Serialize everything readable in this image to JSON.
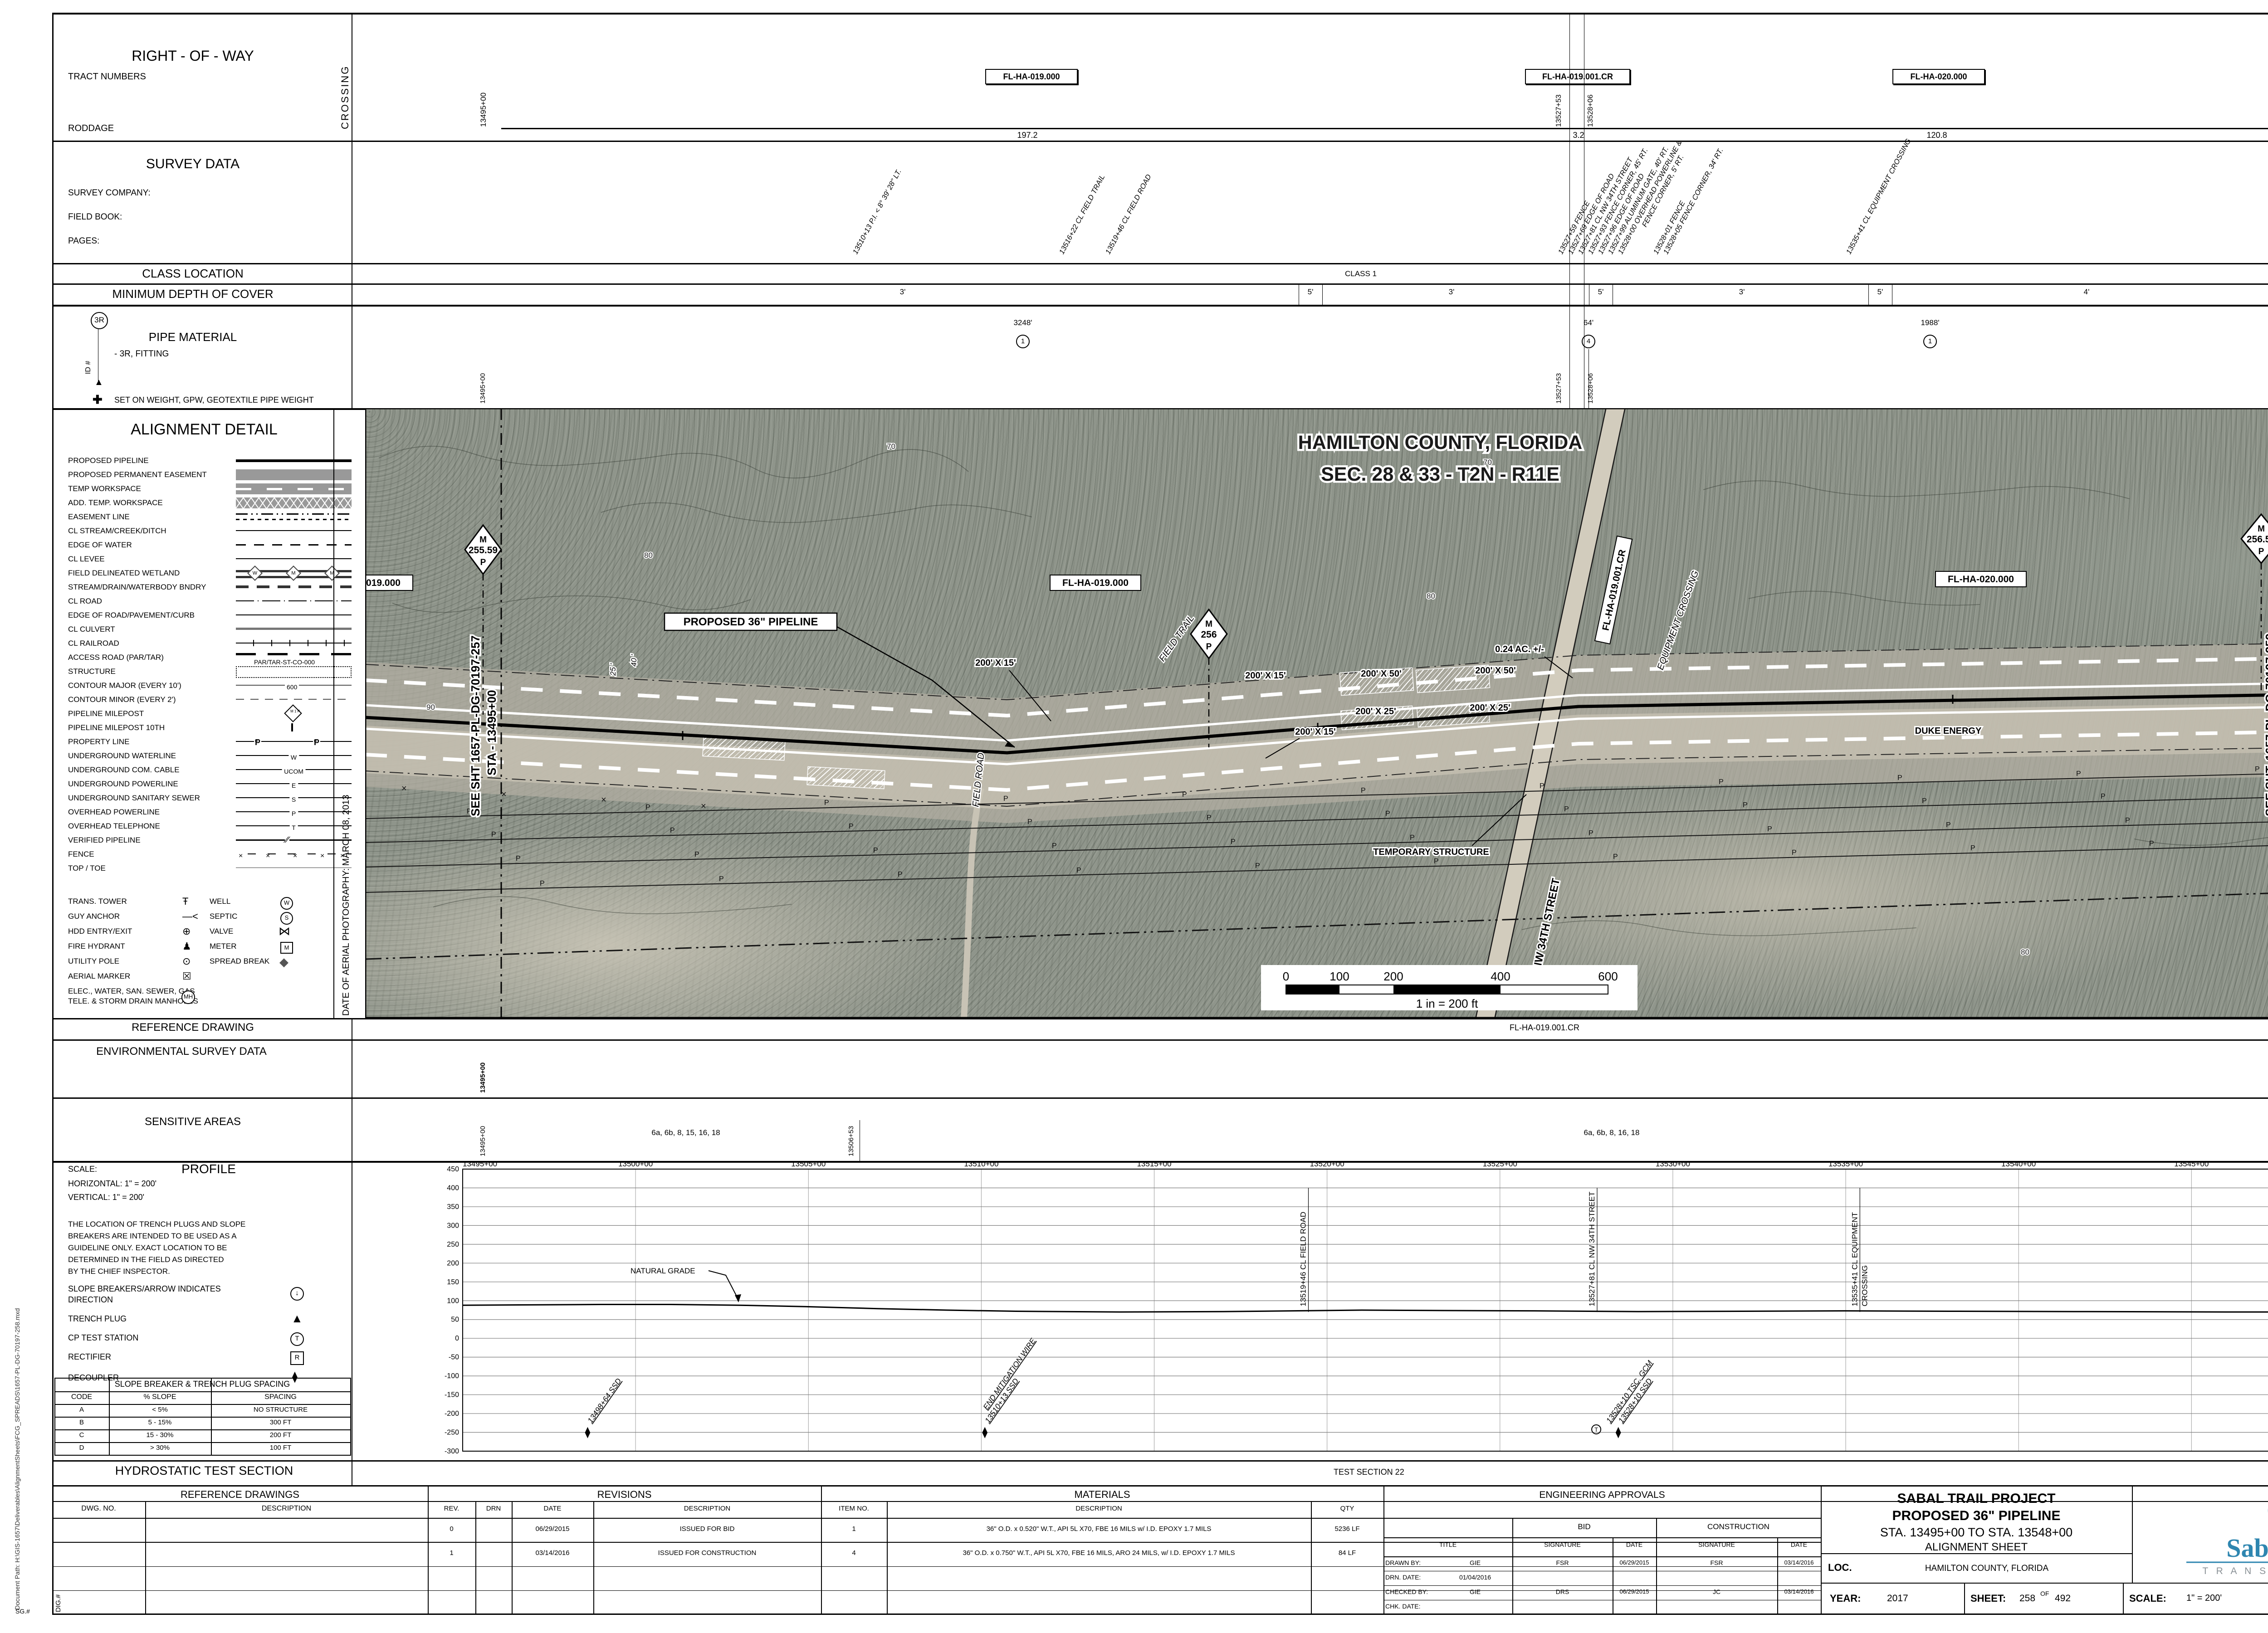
{
  "margin": {
    "doc_path": "Document Path: H:\\GIS-1657\\Deliverables\\AlignmentSheets\\FCG_SPREADS\\1657-PL-DG-70197-258.mxd",
    "dig_no": "DIG.#",
    "sg_no": "SG.#"
  },
  "right_of_way": {
    "title": "RIGHT - OF - WAY",
    "tract_numbers": "TRACT NUMBERS",
    "roddage": "RODDAGE",
    "crossing": "CROSSING",
    "station_left": "13495+00",
    "station_right": "13548+00",
    "crossing_station_1": "13527+53",
    "crossing_station_2": "13528+06",
    "tags": [
      "FL-HA-019.000",
      "FL-HA-019.001.CR",
      "FL-HA-020.000"
    ],
    "roddage_values": [
      "197.2",
      "3.2",
      "120.8"
    ]
  },
  "survey": {
    "title": "SURVEY DATA",
    "company": "SURVEY COMPANY:",
    "field_book": "FIELD BOOK:",
    "pages": "PAGES:",
    "callouts_left": [
      "13510+13 P.I. < 8° 39' 28\" LT.",
      "13516+22 CL FIELD TRAIL",
      "13519+46 CL FIELD ROAD"
    ],
    "callouts_right": [
      "13527+59 FENCE",
      "13527+69 EDGE OF ROAD",
      "13527+81 CL NW 34TH STREET",
      "13527+93 FENCE CORNER, 45' RT.",
      "13527+96 EDGE OF ROAD",
      "13527+99 ALUMINUM GATE, 40' RT.",
      "13528+00 OVERHEAD POWERLINE &",
      "FENCE CORNER, 5' RT.",
      "13528+01 FENCE",
      "13528+05 FENCE CORNER, 34' RT."
    ],
    "callout_far": "13535+41 CL EQUIPMENT CROSSING"
  },
  "class_location": {
    "label": "CLASS LOCATION",
    "value": "CLASS 1"
  },
  "depth": {
    "label": "MINIMUM DEPTH OF COVER",
    "values": [
      "3'",
      "5'",
      "3'",
      "5'",
      "3'",
      "5'",
      "4'"
    ]
  },
  "pipe_material": {
    "label": "PIPE MATERIAL",
    "id_tag": "3R",
    "id_axis": "ID #",
    "fitting_note": "- 3R, FITTING",
    "weight_note": "SET ON WEIGHT, GPW, GEOTEXTILE PIPE WEIGHT",
    "segments": [
      {
        "length": "3248'",
        "id": "1"
      },
      {
        "length": "64'",
        "id": "4"
      },
      {
        "length": "1988'",
        "id": "1"
      }
    ],
    "station_left": "13495+00",
    "station_right": "13548+00",
    "crossing_station_1": "13527+53",
    "crossing_station_2": "13528+06"
  },
  "legend": {
    "title": "ALIGNMENT DETAIL",
    "items": [
      {
        "label": "PROPOSED PIPELINE",
        "style": "pipeline"
      },
      {
        "label": "PROPOSED PERMANENT EASEMENT",
        "style": "permeas"
      },
      {
        "label": "TEMP WORKSPACE",
        "style": "tempws"
      },
      {
        "label": "ADD. TEMP. WORKSPACE",
        "style": "atws"
      },
      {
        "label": "EASEMENT LINE",
        "style": "easement"
      },
      {
        "label": "CL STREAM/CREEK/DITCH",
        "style": "thin"
      },
      {
        "label": "EDGE OF WATER",
        "style": "dash"
      },
      {
        "label": "CL LEVEE",
        "style": "thin"
      },
      {
        "label": "FIELD DELINEATED WETLAND",
        "style": "wetland",
        "tag": "W"
      },
      {
        "label": "STREAM/DRAIN/WATERBODY BNDRY",
        "style": "bndry"
      },
      {
        "label": "CL ROAD",
        "style": "clroad"
      },
      {
        "label": "EDGE OF ROAD/PAVEMENT/CURB",
        "style": "thin"
      },
      {
        "label": "CL CULVERT",
        "style": "culvert"
      },
      {
        "label": "CL RAILROAD",
        "style": "railroad"
      },
      {
        "label": "ACCESS ROAD (PAR/TAR)",
        "style": "access",
        "tag": "PAR/TAR-ST-CO-000"
      },
      {
        "label": "STRUCTURE",
        "style": "structure"
      },
      {
        "label": "CONTOUR MAJOR (EVERY 10')",
        "style": "cmajor",
        "tag": "600"
      },
      {
        "label": "CONTOUR MINOR (EVERY 2')",
        "style": "cminor"
      },
      {
        "label": "PIPELINE MILEPOST",
        "style": "milepost",
        "tag": "M 1 P"
      },
      {
        "label": "PIPELINE MILEPOST 10TH",
        "style": "mp10"
      },
      {
        "label": "PROPERTY LINE",
        "style": "property",
        "tag": "Ᵽ"
      },
      {
        "label": "UNDERGROUND WATERLINE",
        "style": "uline",
        "tag": "W"
      },
      {
        "label": "UNDERGROUND COM. CABLE",
        "style": "uline",
        "tag": "UCOM"
      },
      {
        "label": "UNDERGROUND POWERLINE",
        "style": "uline",
        "tag": "E"
      },
      {
        "label": "UNDERGROUND SANITARY SEWER",
        "style": "uline",
        "tag": "S"
      },
      {
        "label": "OVERHEAD POWERLINE",
        "style": "uline",
        "tag": "P"
      },
      {
        "label": "OVERHEAD TELEPHONE",
        "style": "uline",
        "tag": "T"
      },
      {
        "label": "VERIFIED PIPELINE",
        "style": "verified",
        "tag": "∕∕"
      },
      {
        "label": "FENCE",
        "style": "fence",
        "tag": "×"
      },
      {
        "label": "TOP / TOE",
        "style": "toptoe"
      }
    ],
    "symbols_left": [
      {
        "label": "TRANS. TOWER",
        "sym": "Ŧ"
      },
      {
        "label": "GUY ANCHOR",
        "sym": "—<"
      },
      {
        "label": "HDD ENTRY/EXIT",
        "sym": "⊕"
      },
      {
        "label": "FIRE HYDRANT",
        "sym": "♟"
      },
      {
        "label": "UTILITY POLE",
        "sym": "⊙"
      },
      {
        "label": "AERIAL MARKER",
        "sym": "☒"
      },
      {
        "label": "ELEC., WATER, SAN. SEWER, GAS",
        "label2": "TELE. & STORM DRAIN MANHOLES",
        "sym": "MH"
      }
    ],
    "symbols_right": [
      {
        "label": "WELL",
        "sym": "W"
      },
      {
        "label": "SEPTIC",
        "sym": "S"
      },
      {
        "label": "VALVE",
        "sym": "⋈"
      },
      {
        "label": "METER",
        "sym": "M"
      },
      {
        "label": "SPREAD BREAK",
        "sym": "◆"
      }
    ],
    "aerial_date": "DATE OF AERIAL PHOTOGRAPHY: MARCH 08, 2013"
  },
  "map": {
    "title_line1": "HAMILTON COUNTY, FLORIDA",
    "title_line2": "SEC. 28 & 33 - T2N - R11E",
    "labels": {
      "tag_019": "FL-HA-019.000",
      "tag_019_cr": "FL-HA-019.001.CR",
      "tag_020": "FL-HA-020.000",
      "proposed": "PROPOSED 36\" PIPELINE",
      "street": "NW 34TH STREET",
      "equipment": "EQUIPMENT CROSSING",
      "duke": "DUKE ENERGY",
      "temp_structure": "TEMPORARY STRUCTURE",
      "acreage": "0.24 AC. +/-",
      "ws_50": "200' X 50'",
      "ws_25": "200' X 25'",
      "ws_15": "200' X 15'",
      "field_trail": "FIELD TRAIL",
      "field_road": "FIELD ROAD",
      "dim_25": "25 '",
      "dim_40": "40 '",
      "contours": [
        "70",
        "80",
        "90"
      ],
      "powerline_letter": "P",
      "fence_mark": "×"
    },
    "mileposts": [
      {
        "label": "M",
        "value": "255.59",
        "suffix": "P"
      },
      {
        "label": "M",
        "value": "256",
        "suffix": "P"
      },
      {
        "label": "M",
        "value": "256.59",
        "suffix": "P"
      }
    ],
    "matchline_left1": "SEE SHT 1657-PL-DG-70197-257",
    "matchline_left2": "STA - 13495+00",
    "matchline_right1": "SEE SHT. 1657-PL-DG-70197-259",
    "matchline_right2": "STA - 13548+00",
    "scalebar": {
      "ticks": [
        "0",
        "100",
        "200",
        "400",
        "600"
      ],
      "caption": "1 in = 200 ft"
    }
  },
  "reference_drawing": {
    "label": "REFERENCE DRAWING",
    "value": "FL-HA-019.001.CR"
  },
  "environmental": {
    "label": "ENVIRONMENTAL SURVEY DATA",
    "station_left": "13495+00",
    "station_right": "13548+00"
  },
  "sensitive": {
    "label": "SENSITIVE AREAS",
    "values": [
      "6a, 6b, 8, 15, 16, 18",
      "6a, 6b, 8, 16, 18"
    ],
    "station_left": "13495+00",
    "station_mid": "13506+53",
    "station_right": "13548+00"
  },
  "profile_panel": {
    "title": "PROFILE",
    "scale_label": "SCALE:",
    "horizontal": "HORIZONTAL:  1\" = 200'",
    "vertical": "VERTICAL:  1\" = 200'",
    "note_lines": [
      "THE LOCATION OF TRENCH PLUGS AND SLOPE",
      "BREAKERS ARE INTENDED TO BE USED AS A",
      "GUIDELINE ONLY.  EXACT LOCATION TO BE",
      "DETERMINED IN THE FIELD AS DIRECTED",
      "BY THE CHIEF INSPECTOR."
    ],
    "legend": [
      {
        "label": "SLOPE BREAKERS/ARROW INDICATES",
        "label2": "DIRECTION",
        "sym": "slope"
      },
      {
        "label": "TRENCH PLUG",
        "sym": "plug"
      },
      {
        "label": "CP TEST STATION",
        "sym": "cp"
      },
      {
        "label": "RECTIFIER",
        "sym": "rect"
      },
      {
        "label": "DECOUPLER",
        "sym": "dec"
      }
    ],
    "spacing": {
      "title": "SLOPE BREAKER & TRENCH PLUG SPACING",
      "cols": [
        "CODE",
        "% SLOPE",
        "SPACING"
      ],
      "rows": [
        [
          "A",
          "< 5%",
          "NO STRUCTURE"
        ],
        [
          "B",
          "5 - 15%",
          "300 FT"
        ],
        [
          "C",
          "15 - 30%",
          "200 FT"
        ],
        [
          "D",
          "> 30%",
          "100 FT"
        ]
      ]
    }
  },
  "chart_data": {
    "type": "line",
    "title": "PROFILE",
    "xlabel": "STATION",
    "ylabel": "ELEVATION (FT)",
    "x_ticks": [
      "13495+00",
      "13500+00",
      "13505+00",
      "13510+00",
      "13515+00",
      "13520+00",
      "13525+00",
      "13530+00",
      "13535+00",
      "13540+00",
      "13545+00",
      "13548+00"
    ],
    "x_numeric": [
      13495,
      13500,
      13505,
      13510,
      13515,
      13520,
      13525,
      13530,
      13535,
      13540,
      13545,
      13548
    ],
    "y_ticks": [
      450,
      400,
      350,
      300,
      250,
      200,
      150,
      100,
      50,
      0,
      -50,
      -100,
      -150,
      -200,
      -250,
      -300
    ],
    "ylim": [
      -300,
      450
    ],
    "xlim_station": [
      13495,
      13548
    ],
    "grid": true,
    "series": [
      {
        "name": "NATURAL GRADE",
        "x": [
          13495,
          13497,
          13499,
          13501,
          13503,
          13505,
          13507,
          13509,
          13511,
          13514,
          13517,
          13519,
          13521,
          13523,
          13526,
          13529,
          13532,
          13535,
          13538,
          13542,
          13546,
          13548
        ],
        "values": [
          88,
          89,
          90,
          90,
          88,
          84,
          79,
          75,
          72,
          70,
          71,
          73,
          75,
          74,
          73,
          71,
          72,
          73,
          72,
          71,
          70,
          70
        ]
      }
    ],
    "annotations": {
      "grade_label": "NATURAL GRADE",
      "verticals": [
        {
          "station": 13519.46,
          "label": "13519+46 CL FIELD ROAD"
        },
        {
          "station": 13527.81,
          "label": "13527+81 CL NW 34TH STREET"
        },
        {
          "station": 13535.41,
          "label": "13535+41 CL EQUIPMENT",
          "label2": "CROSSING"
        }
      ],
      "diagonals": [
        {
          "station": 13498.64,
          "label": "13498+64 SSD",
          "symbol": "decoupler"
        },
        {
          "station": 13510.13,
          "label": "13510+13 SSD",
          "label2": "END MITIGATION WIRE",
          "symbol": "decoupler"
        },
        {
          "station": 13528.1,
          "label": "13528+10 TSC, GCM",
          "symbol": "cp-test"
        },
        {
          "station": 13528.45,
          "label": "13528+10 SSD",
          "symbol": "decoupler"
        }
      ]
    }
  },
  "hydro": {
    "label": "HYDROSTATIC TEST SECTION",
    "value": "TEST SECTION 22"
  },
  "tables": {
    "reference_drawings": {
      "title": "REFERENCE DRAWINGS",
      "cols": [
        "DWG. NO.",
        "DESCRIPTION"
      ],
      "rows": [
        [
          "",
          ""
        ],
        [
          "",
          ""
        ],
        [
          "",
          ""
        ],
        [
          "",
          ""
        ]
      ]
    },
    "revisions": {
      "title": "REVISIONS",
      "cols": [
        "REV.",
        "DRN",
        "DATE",
        "DESCRIPTION"
      ],
      "rows": [
        [
          "0",
          "",
          "06/29/2015",
          "ISSUED FOR BID"
        ],
        [
          "1",
          "",
          "03/14/2016",
          "ISSUED FOR CONSTRUCTION"
        ],
        [
          "",
          "",
          "",
          ""
        ],
        [
          "",
          "",
          "",
          ""
        ]
      ]
    },
    "materials": {
      "title": "MATERIALS",
      "cols": [
        "ITEM NO.",
        "DESCRIPTION",
        "QTY"
      ],
      "rows": [
        [
          "1",
          "36\" O.D. x 0.520\" W.T., API 5L X70, FBE 16 MILS w/ I.D. EPOXY 1.7 MILS",
          "5236 LF"
        ],
        [
          "4",
          "36\" O.D. x 0.750\" W.T., API 5L X70, FBE 16 MILS, ARO 24 MILS, w/ I.D. EPOXY 1.7 MILS",
          "84 LF"
        ],
        [
          "",
          "",
          ""
        ],
        [
          "",
          "",
          ""
        ]
      ]
    },
    "approvals": {
      "title": "ENGINEERING APPROVALS",
      "bid": "BID",
      "construction": "CONSTRUCTION",
      "cols": [
        "TITLE",
        "SIGNATURE",
        "DATE",
        "SIGNATURE",
        "DATE"
      ],
      "rows": [
        [
          "DRAWN BY:",
          "GIE",
          "FSR",
          "06/29/2015",
          "FSR",
          "03/14/2016"
        ],
        [
          "DRN. DATE:",
          "01/04/2016",
          "",
          "",
          "",
          ""
        ],
        [
          "CHECKED BY:",
          "GIE",
          "DRS",
          "06/29/2015",
          "JC",
          "03/14/2016"
        ],
        [
          "CHK. DATE:",
          "",
          "",
          "",
          "",
          ""
        ]
      ]
    }
  },
  "titleblock": {
    "project_line1": "SABAL TRAIL PROJECT",
    "project_line2": "PROPOSED 36\" PIPELINE",
    "project_line3": "STA. 13495+00 TO STA. 13548+00",
    "project_line4": "ALIGNMENT SHEET",
    "loc_label": "LOC.",
    "loc_value": "HAMILTON COUNTY, FLORIDA",
    "year_label": "YEAR:",
    "year": "2017",
    "sheet_label": "SHEET:",
    "sheet_no": "258",
    "of": "OF",
    "sheet_total": "492",
    "scale_label": "SCALE:",
    "scale": "1\" = 200'",
    "dwg_label": "DWG.",
    "dwg": "1657-PL-DG-70197-258",
    "rev_label": "REV.",
    "rev": "1"
  },
  "logo": {
    "name": "Sabal Trail",
    "sub": "T R A N S M I S S I O N",
    "sm": "SM",
    "blue": "#2e86b0",
    "gray": "#8a9196"
  }
}
